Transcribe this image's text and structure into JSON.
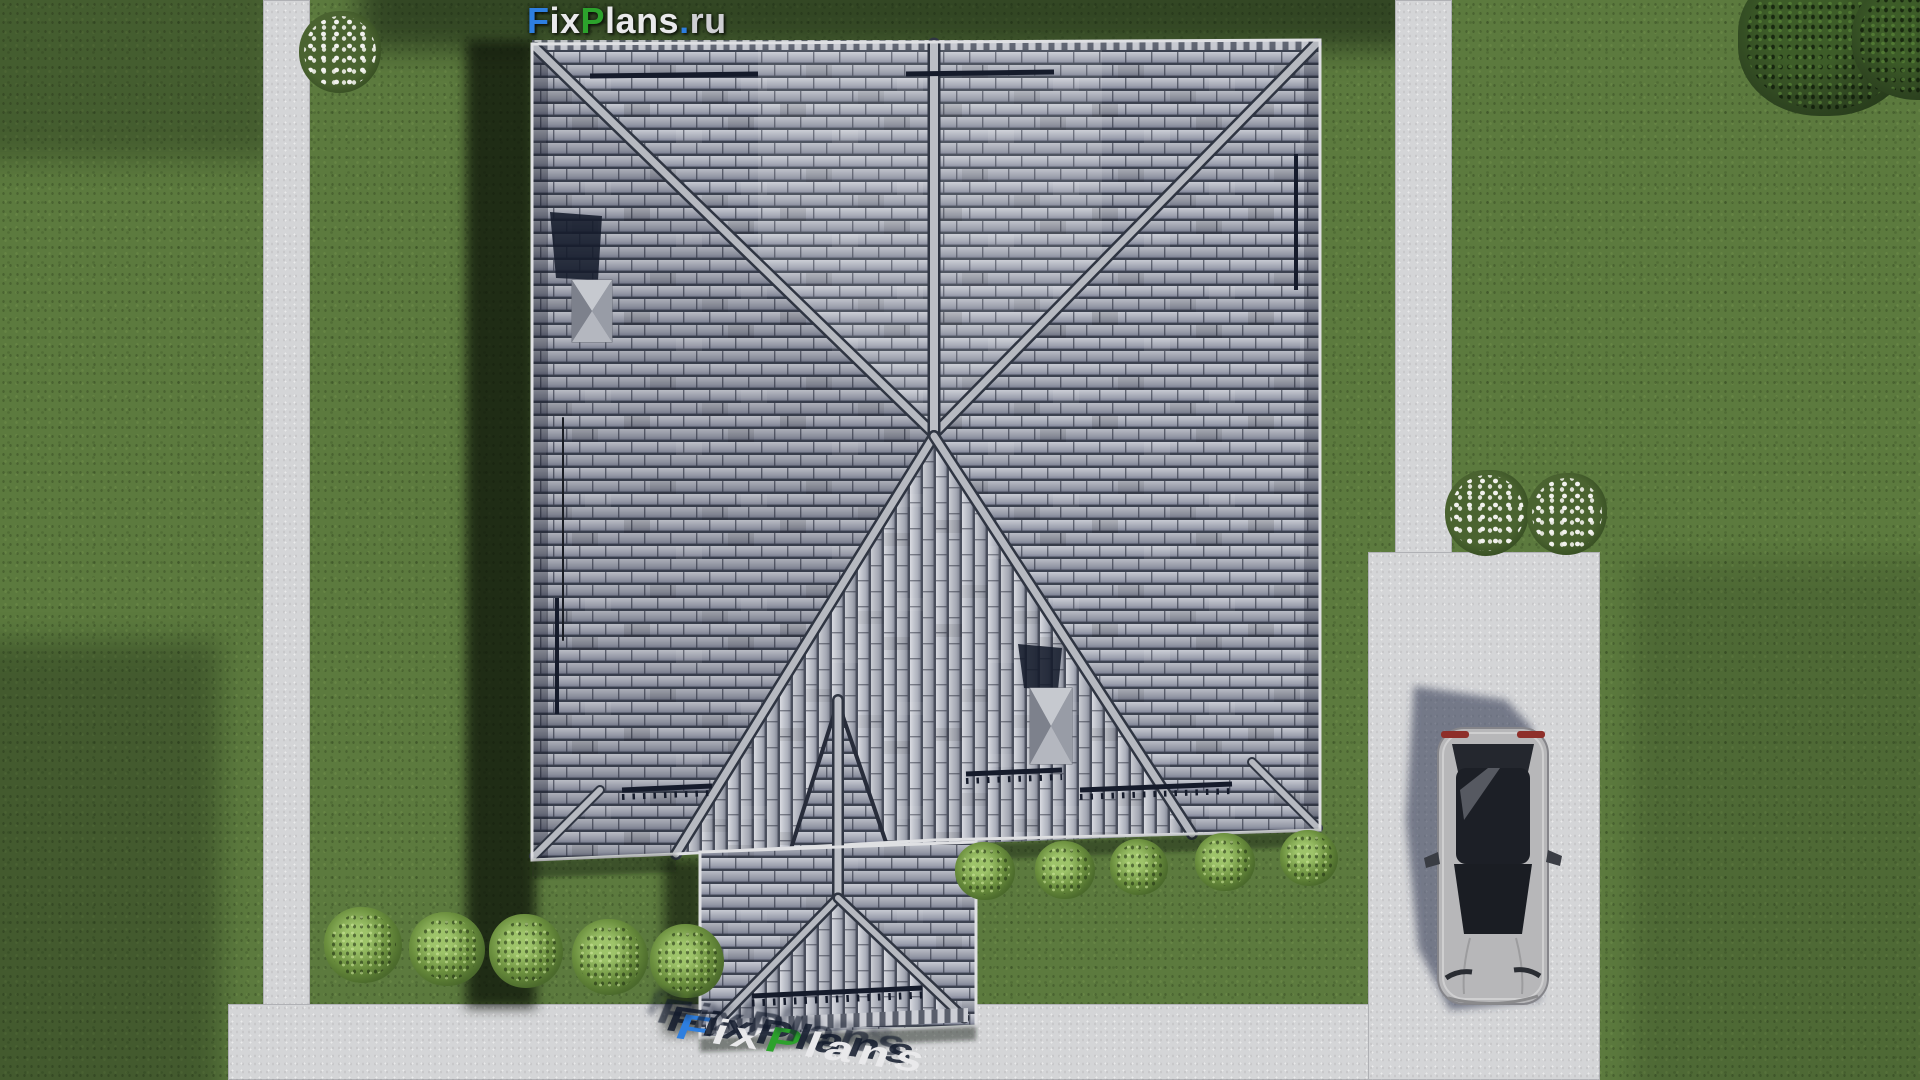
{
  "branding": {
    "site_logo": {
      "segments": [
        {
          "text": "F",
          "color_key": "logo_blue"
        },
        {
          "text": "ix",
          "color_key": "logo_white"
        },
        {
          "text": "P",
          "color_key": "logo_green"
        },
        {
          "text": "lans",
          "color_key": "logo_white"
        },
        {
          "text": ".",
          "color_key": "logo_blue"
        },
        {
          "text": "ru",
          "color_key": "logo_silver"
        }
      ]
    },
    "ground_logo": {
      "segments": [
        {
          "text": "F",
          "color_key": "logo_blue"
        },
        {
          "text": "ix",
          "color_key": "logo_white"
        },
        {
          "text": "P",
          "color_key": "logo_green"
        },
        {
          "text": "lans",
          "color_key": "logo_white"
        }
      ]
    }
  },
  "scene": {
    "view": "top-down aerial render of a house plot",
    "objects": [
      "lawn",
      "left walkway",
      "bottom walkway",
      "right walkway",
      "driveway",
      "hip roof with gable triangle",
      "porch gable roof",
      "chimney",
      "chimney",
      "snow guards",
      "antenna",
      "silver sedan car",
      "garden bushes",
      "white flowering shrubs",
      "trees"
    ],
    "counts": {
      "bushes": 10,
      "flowering_shrubs": 3,
      "trees": 2,
      "cars": 1,
      "chimneys": 2
    }
  },
  "colors": {
    "grass_base": "#5c7a3e",
    "grass_dark": "#3a5226",
    "pavement": "#d4d5d7",
    "roof_tile_light": "#c7cad2",
    "roof_tile_mid": "#9da1af",
    "roof_tile_dark": "#3c4250",
    "roof_ridge": "#b6b9c0",
    "shadow_navy": "#151b2b",
    "bush_green": "#6b8f3e",
    "bush_light": "#9ec46a",
    "flower_white": "#f2f2ee",
    "tree_dark": "#2e4420",
    "car_silver": "#b7b7b9",
    "car_glass": "#1c1f26",
    "car_taillight": "#8e2f2a",
    "logo_blue": "#2e7fe0",
    "logo_green": "#2ca22c",
    "logo_white": "#e9e9eb",
    "logo_silver": "#cfcfd3"
  }
}
